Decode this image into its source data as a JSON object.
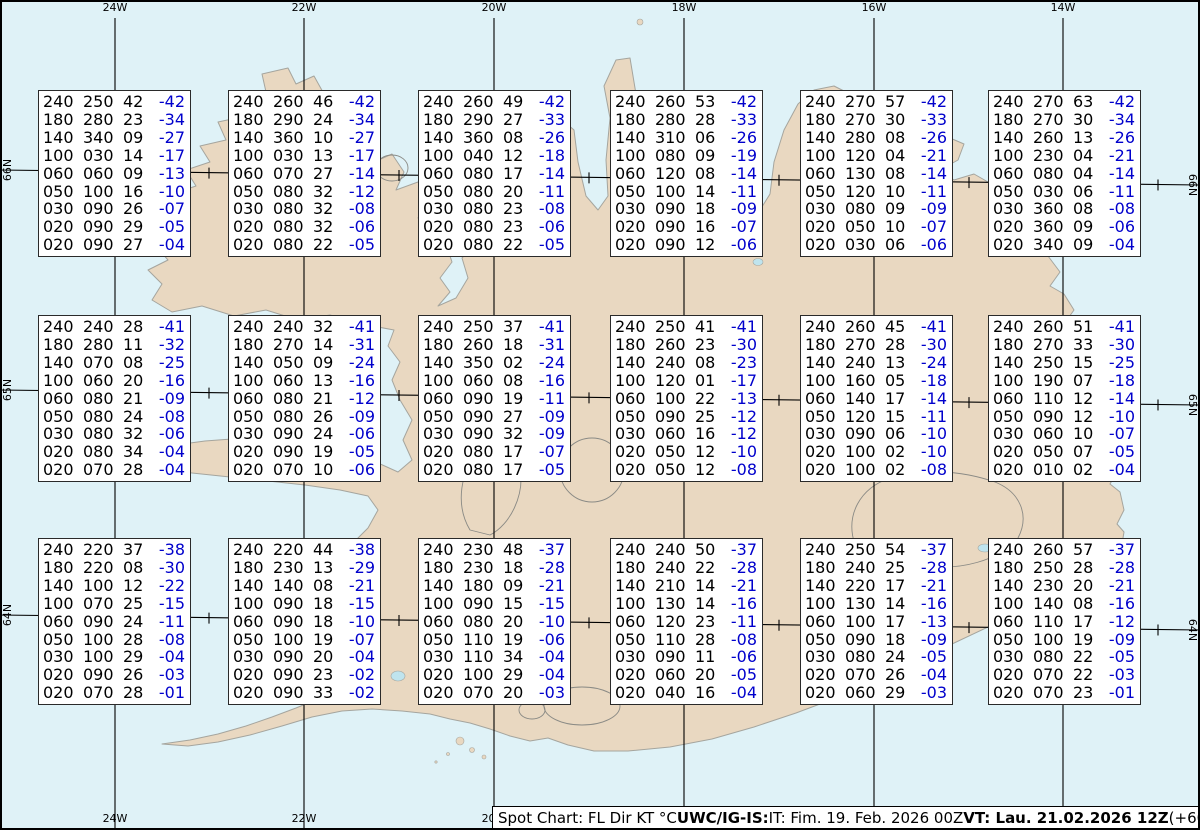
{
  "map": {
    "region": "Iceland",
    "colors": {
      "ocean": "#dff2f7",
      "land": "#e9d8c1",
      "coast": "#a5a59e",
      "glacier": "#8a8a85",
      "lake": "#bfe4ee",
      "grid": "#000000",
      "box_border": "#2a2a2a",
      "temperature_text": "#0000cc"
    },
    "lon_lines": [
      {
        "label": "24W",
        "x": 115
      },
      {
        "label": "22W",
        "x": 304
      },
      {
        "label": "20W",
        "x": 494
      },
      {
        "label": "18W",
        "x": 684
      },
      {
        "label": "16W",
        "x": 874
      },
      {
        "label": "14W",
        "x": 1063
      }
    ],
    "lat_lines": [
      {
        "label": "66N",
        "y_left": 170,
        "y_right": 185
      },
      {
        "label": "65N",
        "y_left": 390,
        "y_right": 405
      },
      {
        "label": "64N",
        "y_left": 615,
        "y_right": 630
      }
    ],
    "half_lon_tick_x": [
      209,
      399,
      589,
      779,
      969,
      1158
    ],
    "lon_label_top_y": 2,
    "lon_label_bottom_y": 813,
    "bottom_labels_visible": [
      "24W",
      "22W",
      "20W"
    ]
  },
  "spot_boxes": {
    "columns": [
      "FL",
      "Dir",
      "KT",
      "C"
    ],
    "cols_x": [
      38,
      228,
      418,
      610,
      800,
      988
    ],
    "rows_y": [
      90,
      315,
      538
    ],
    "boxes": [
      {
        "rows": [
          [
            "240",
            "250",
            "42",
            "-42"
          ],
          [
            "180",
            "280",
            "23",
            "-34"
          ],
          [
            "140",
            "340",
            "09",
            "-27"
          ],
          [
            "100",
            "030",
            "14",
            "-17"
          ],
          [
            "060",
            "060",
            "09",
            "-13"
          ],
          [
            "050",
            "100",
            "16",
            "-10"
          ],
          [
            "030",
            "090",
            "26",
            "-07"
          ],
          [
            "020",
            "090",
            "29",
            "-05"
          ],
          [
            "020",
            "090",
            "27",
            "-04"
          ]
        ]
      },
      {
        "rows": [
          [
            "240",
            "260",
            "46",
            "-42"
          ],
          [
            "180",
            "290",
            "24",
            "-34"
          ],
          [
            "140",
            "360",
            "10",
            "-27"
          ],
          [
            "100",
            "030",
            "13",
            "-17"
          ],
          [
            "060",
            "070",
            "27",
            "-14"
          ],
          [
            "050",
            "080",
            "32",
            "-12"
          ],
          [
            "030",
            "080",
            "32",
            "-08"
          ],
          [
            "020",
            "080",
            "32",
            "-06"
          ],
          [
            "020",
            "080",
            "22",
            "-05"
          ]
        ]
      },
      {
        "rows": [
          [
            "240",
            "260",
            "49",
            "-42"
          ],
          [
            "180",
            "290",
            "27",
            "-33"
          ],
          [
            "140",
            "360",
            "08",
            "-26"
          ],
          [
            "100",
            "040",
            "12",
            "-18"
          ],
          [
            "060",
            "080",
            "17",
            "-14"
          ],
          [
            "050",
            "080",
            "20",
            "-11"
          ],
          [
            "030",
            "080",
            "23",
            "-08"
          ],
          [
            "020",
            "080",
            "23",
            "-06"
          ],
          [
            "020",
            "080",
            "22",
            "-05"
          ]
        ]
      },
      {
        "rows": [
          [
            "240",
            "260",
            "53",
            "-42"
          ],
          [
            "180",
            "280",
            "28",
            "-33"
          ],
          [
            "140",
            "310",
            "06",
            "-26"
          ],
          [
            "100",
            "080",
            "09",
            "-19"
          ],
          [
            "060",
            "120",
            "08",
            "-14"
          ],
          [
            "050",
            "100",
            "14",
            "-11"
          ],
          [
            "030",
            "090",
            "18",
            "-09"
          ],
          [
            "020",
            "090",
            "16",
            "-07"
          ],
          [
            "020",
            "090",
            "12",
            "-06"
          ]
        ]
      },
      {
        "rows": [
          [
            "240",
            "270",
            "57",
            "-42"
          ],
          [
            "180",
            "270",
            "30",
            "-33"
          ],
          [
            "140",
            "280",
            "08",
            "-26"
          ],
          [
            "100",
            "120",
            "04",
            "-21"
          ],
          [
            "060",
            "130",
            "08",
            "-14"
          ],
          [
            "050",
            "120",
            "10",
            "-11"
          ],
          [
            "030",
            "080",
            "09",
            "-09"
          ],
          [
            "020",
            "050",
            "10",
            "-07"
          ],
          [
            "020",
            "030",
            "06",
            "-06"
          ]
        ]
      },
      {
        "rows": [
          [
            "240",
            "270",
            "63",
            "-42"
          ],
          [
            "180",
            "270",
            "30",
            "-34"
          ],
          [
            "140",
            "260",
            "13",
            "-26"
          ],
          [
            "100",
            "230",
            "04",
            "-21"
          ],
          [
            "060",
            "080",
            "04",
            "-14"
          ],
          [
            "050",
            "030",
            "06",
            "-11"
          ],
          [
            "030",
            "360",
            "08",
            "-08"
          ],
          [
            "020",
            "360",
            "09",
            "-06"
          ],
          [
            "020",
            "340",
            "09",
            "-04"
          ]
        ]
      },
      {
        "rows": [
          [
            "240",
            "240",
            "28",
            "-41"
          ],
          [
            "180",
            "280",
            "11",
            "-32"
          ],
          [
            "140",
            "070",
            "08",
            "-25"
          ],
          [
            "100",
            "060",
            "20",
            "-16"
          ],
          [
            "060",
            "080",
            "21",
            "-09"
          ],
          [
            "050",
            "080",
            "24",
            "-08"
          ],
          [
            "030",
            "080",
            "32",
            "-06"
          ],
          [
            "020",
            "080",
            "34",
            "-04"
          ],
          [
            "020",
            "070",
            "28",
            "-04"
          ]
        ]
      },
      {
        "rows": [
          [
            "240",
            "240",
            "32",
            "-41"
          ],
          [
            "180",
            "270",
            "14",
            "-31"
          ],
          [
            "140",
            "050",
            "09",
            "-24"
          ],
          [
            "100",
            "060",
            "13",
            "-16"
          ],
          [
            "060",
            "080",
            "21",
            "-12"
          ],
          [
            "050",
            "080",
            "26",
            "-09"
          ],
          [
            "030",
            "090",
            "24",
            "-06"
          ],
          [
            "020",
            "090",
            "19",
            "-05"
          ],
          [
            "020",
            "070",
            "10",
            "-06"
          ]
        ]
      },
      {
        "rows": [
          [
            "240",
            "250",
            "37",
            "-41"
          ],
          [
            "180",
            "260",
            "18",
            "-31"
          ],
          [
            "140",
            "350",
            "02",
            "-24"
          ],
          [
            "100",
            "060",
            "08",
            "-16"
          ],
          [
            "060",
            "090",
            "19",
            "-11"
          ],
          [
            "050",
            "090",
            "27",
            "-09"
          ],
          [
            "030",
            "090",
            "32",
            "-09"
          ],
          [
            "020",
            "080",
            "17",
            "-07"
          ],
          [
            "020",
            "080",
            "17",
            "-05"
          ]
        ]
      },
      {
        "rows": [
          [
            "240",
            "250",
            "41",
            "-41"
          ],
          [
            "180",
            "260",
            "23",
            "-30"
          ],
          [
            "140",
            "240",
            "08",
            "-23"
          ],
          [
            "100",
            "120",
            "01",
            "-17"
          ],
          [
            "060",
            "100",
            "22",
            "-13"
          ],
          [
            "050",
            "090",
            "25",
            "-12"
          ],
          [
            "030",
            "060",
            "16",
            "-12"
          ],
          [
            "020",
            "050",
            "12",
            "-10"
          ],
          [
            "020",
            "050",
            "12",
            "-08"
          ]
        ]
      },
      {
        "rows": [
          [
            "240",
            "260",
            "45",
            "-41"
          ],
          [
            "180",
            "270",
            "28",
            "-30"
          ],
          [
            "140",
            "240",
            "13",
            "-24"
          ],
          [
            "100",
            "160",
            "05",
            "-18"
          ],
          [
            "060",
            "140",
            "17",
            "-14"
          ],
          [
            "050",
            "120",
            "15",
            "-11"
          ],
          [
            "030",
            "090",
            "06",
            "-10"
          ],
          [
            "020",
            "100",
            "02",
            "-10"
          ],
          [
            "020",
            "100",
            "02",
            "-08"
          ]
        ]
      },
      {
        "rows": [
          [
            "240",
            "260",
            "51",
            "-41"
          ],
          [
            "180",
            "270",
            "33",
            "-30"
          ],
          [
            "140",
            "250",
            "15",
            "-25"
          ],
          [
            "100",
            "190",
            "07",
            "-18"
          ],
          [
            "060",
            "110",
            "12",
            "-14"
          ],
          [
            "050",
            "090",
            "12",
            "-10"
          ],
          [
            "030",
            "060",
            "10",
            "-07"
          ],
          [
            "020",
            "050",
            "07",
            "-05"
          ],
          [
            "020",
            "010",
            "02",
            "-04"
          ]
        ]
      },
      {
        "rows": [
          [
            "240",
            "220",
            "37",
            "-38"
          ],
          [
            "180",
            "220",
            "08",
            "-30"
          ],
          [
            "140",
            "100",
            "12",
            "-22"
          ],
          [
            "100",
            "070",
            "25",
            "-15"
          ],
          [
            "060",
            "090",
            "24",
            "-11"
          ],
          [
            "050",
            "100",
            "28",
            "-08"
          ],
          [
            "030",
            "100",
            "29",
            "-04"
          ],
          [
            "020",
            "090",
            "26",
            "-03"
          ],
          [
            "020",
            "070",
            "28",
            "-01"
          ]
        ]
      },
      {
        "rows": [
          [
            "240",
            "220",
            "44",
            "-38"
          ],
          [
            "180",
            "230",
            "13",
            "-29"
          ],
          [
            "140",
            "140",
            "08",
            "-21"
          ],
          [
            "100",
            "090",
            "18",
            "-15"
          ],
          [
            "060",
            "090",
            "18",
            "-10"
          ],
          [
            "050",
            "100",
            "19",
            "-07"
          ],
          [
            "030",
            "090",
            "20",
            "-04"
          ],
          [
            "020",
            "090",
            "23",
            "-02"
          ],
          [
            "020",
            "090",
            "33",
            "-02"
          ]
        ]
      },
      {
        "rows": [
          [
            "240",
            "230",
            "48",
            "-37"
          ],
          [
            "180",
            "230",
            "18",
            "-28"
          ],
          [
            "140",
            "180",
            "09",
            "-21"
          ],
          [
            "100",
            "090",
            "15",
            "-15"
          ],
          [
            "060",
            "080",
            "20",
            "-10"
          ],
          [
            "050",
            "110",
            "19",
            "-06"
          ],
          [
            "030",
            "110",
            "34",
            "-04"
          ],
          [
            "020",
            "100",
            "29",
            "-04"
          ],
          [
            "020",
            "070",
            "20",
            "-03"
          ]
        ]
      },
      {
        "rows": [
          [
            "240",
            "240",
            "50",
            "-37"
          ],
          [
            "180",
            "240",
            "22",
            "-28"
          ],
          [
            "140",
            "210",
            "14",
            "-21"
          ],
          [
            "100",
            "130",
            "14",
            "-16"
          ],
          [
            "060",
            "120",
            "23",
            "-11"
          ],
          [
            "050",
            "110",
            "28",
            "-08"
          ],
          [
            "030",
            "090",
            "11",
            "-06"
          ],
          [
            "020",
            "060",
            "20",
            "-05"
          ],
          [
            "020",
            "040",
            "16",
            "-04"
          ]
        ]
      },
      {
        "rows": [
          [
            "240",
            "250",
            "54",
            "-37"
          ],
          [
            "180",
            "240",
            "25",
            "-28"
          ],
          [
            "140",
            "220",
            "17",
            "-21"
          ],
          [
            "100",
            "130",
            "14",
            "-16"
          ],
          [
            "060",
            "100",
            "17",
            "-13"
          ],
          [
            "050",
            "090",
            "18",
            "-09"
          ],
          [
            "030",
            "080",
            "24",
            "-05"
          ],
          [
            "020",
            "070",
            "26",
            "-04"
          ],
          [
            "020",
            "060",
            "29",
            "-03"
          ]
        ]
      },
      {
        "rows": [
          [
            "240",
            "260",
            "57",
            "-37"
          ],
          [
            "180",
            "250",
            "28",
            "-28"
          ],
          [
            "140",
            "230",
            "20",
            "-21"
          ],
          [
            "100",
            "140",
            "08",
            "-16"
          ],
          [
            "060",
            "110",
            "17",
            "-12"
          ],
          [
            "050",
            "100",
            "19",
            "-09"
          ],
          [
            "030",
            "080",
            "22",
            "-05"
          ],
          [
            "020",
            "070",
            "22",
            "-03"
          ],
          [
            "020",
            "070",
            "23",
            "-01"
          ]
        ]
      }
    ]
  },
  "footer": {
    "segments": [
      {
        "text": "Spot Chart: FL Dir KT °C ",
        "bold": false
      },
      {
        "text": "UWC/IG-IS:",
        "bold": true
      },
      {
        "text": " IT: Fim. 19. Feb. 2026 00Z ",
        "bold": false
      },
      {
        "text": "VT: Lau. 21.02.2026 12Z",
        "bold": true
      },
      {
        "text": " (+60 h)",
        "bold": false
      }
    ]
  }
}
